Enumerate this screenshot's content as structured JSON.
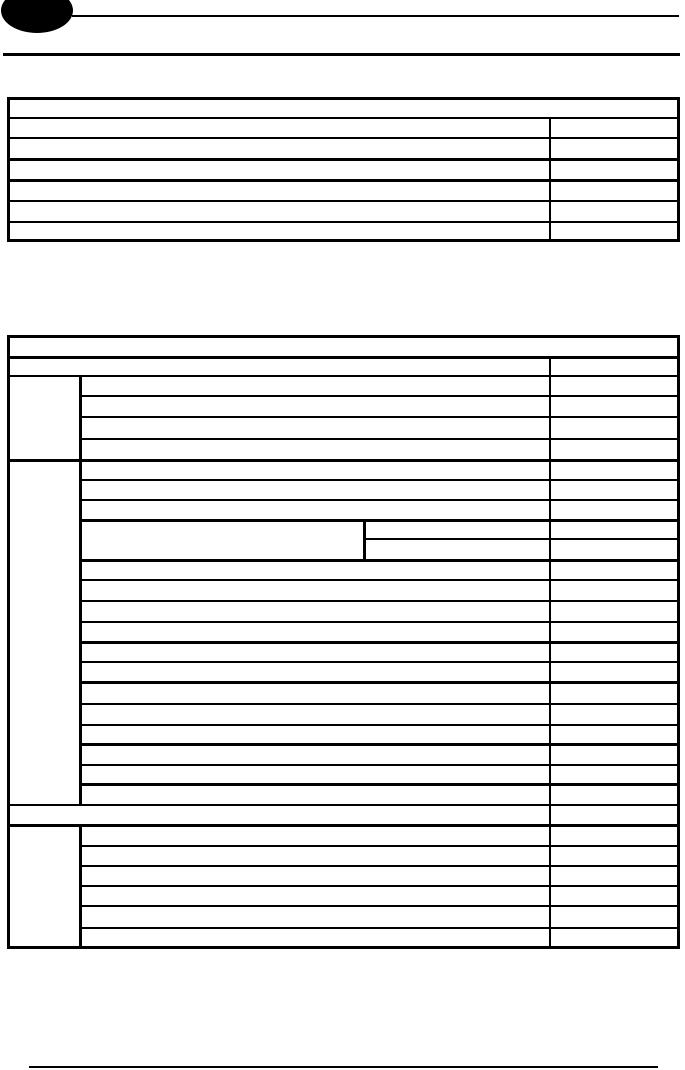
{
  "page": {
    "width": 685,
    "height": 1070,
    "background_color": "#ffffff",
    "line_color": "#000000"
  },
  "document": {
    "content_note": "blank form template page; all table cells are empty, no text is rendered",
    "tables_empty": true
  },
  "tables_meta": {
    "table1": {
      "rows": 7,
      "header_row_full_width": true,
      "value_column_divider_x": 549
    },
    "table2": {
      "header_row_full_width": true,
      "category_column_divider_x": 79,
      "value_column_divider_x": 549,
      "nested_split_divider_x": 363,
      "category_groups": 3,
      "full_width_band_y": 806
    }
  },
  "shapes": [
    {
      "name": "logo-ellipse",
      "type": "ellipse",
      "x": 1,
      "y": -12,
      "w": 72,
      "h": 45
    },
    {
      "name": "header-rule-top",
      "type": "rect",
      "x": 72,
      "y": 15,
      "w": 607,
      "h": 2
    },
    {
      "name": "header-rule-bottom",
      "type": "rect",
      "x": 3,
      "y": 53,
      "w": 677,
      "h": 3
    },
    {
      "name": "table1-border-top",
      "type": "rect",
      "x": 7,
      "y": 97,
      "w": 673,
      "h": 3
    },
    {
      "name": "table1-border-bottom",
      "type": "rect",
      "x": 7,
      "y": 239,
      "w": 673,
      "h": 3
    },
    {
      "name": "table1-border-left",
      "type": "rect",
      "x": 7,
      "y": 97,
      "w": 3,
      "h": 145
    },
    {
      "name": "table1-border-right",
      "type": "rect",
      "x": 677,
      "y": 97,
      "w": 3,
      "h": 145
    },
    {
      "name": "table1-rowline-1",
      "type": "rect",
      "x": 7,
      "y": 117,
      "w": 673,
      "h": 2
    },
    {
      "name": "table1-rowline-2",
      "type": "rect",
      "x": 7,
      "y": 137,
      "w": 673,
      "h": 2
    },
    {
      "name": "table1-rowline-3",
      "type": "rect",
      "x": 7,
      "y": 158,
      "w": 673,
      "h": 3
    },
    {
      "name": "table1-rowline-4",
      "type": "rect",
      "x": 7,
      "y": 179,
      "w": 673,
      "h": 3
    },
    {
      "name": "table1-rowline-5",
      "type": "rect",
      "x": 7,
      "y": 200,
      "w": 673,
      "h": 2
    },
    {
      "name": "table1-rowline-6",
      "type": "rect",
      "x": 7,
      "y": 221,
      "w": 673,
      "h": 2
    },
    {
      "name": "table1-value-divider",
      "type": "rect",
      "x": 549,
      "y": 117,
      "w": 2,
      "h": 125
    },
    {
      "name": "table2-border-top",
      "type": "rect",
      "x": 7,
      "y": 335,
      "w": 673,
      "h": 3
    },
    {
      "name": "table2-border-bottom",
      "type": "rect",
      "x": 7,
      "y": 946,
      "w": 673,
      "h": 3
    },
    {
      "name": "table2-border-left",
      "type": "rect",
      "x": 7,
      "y": 335,
      "w": 3,
      "h": 614
    },
    {
      "name": "table2-border-right",
      "type": "rect",
      "x": 677,
      "y": 335,
      "w": 3,
      "h": 614
    },
    {
      "name": "table2-header-bottom",
      "type": "rect",
      "x": 7,
      "y": 356,
      "w": 673,
      "h": 3
    },
    {
      "name": "table2-rowline-1",
      "type": "rect",
      "x": 7,
      "y": 375,
      "w": 673,
      "h": 2
    },
    {
      "name": "table2-rowline-2",
      "type": "rect",
      "x": 79,
      "y": 395,
      "w": 601,
      "h": 2
    },
    {
      "name": "table2-rowline-3",
      "type": "rect",
      "x": 79,
      "y": 416,
      "w": 601,
      "h": 2
    },
    {
      "name": "table2-rowline-4",
      "type": "rect",
      "x": 79,
      "y": 438,
      "w": 601,
      "h": 2
    },
    {
      "name": "table2-groupline-1",
      "type": "rect",
      "x": 7,
      "y": 459,
      "w": 673,
      "h": 3
    },
    {
      "name": "table2-rowline-5",
      "type": "rect",
      "x": 79,
      "y": 479,
      "w": 601,
      "h": 2
    },
    {
      "name": "table2-rowline-6",
      "type": "rect",
      "x": 79,
      "y": 499,
      "w": 601,
      "h": 2
    },
    {
      "name": "table2-splitblock-top",
      "type": "rect",
      "x": 79,
      "y": 519,
      "w": 601,
      "h": 3
    },
    {
      "name": "table2-splitblock-mid",
      "type": "rect",
      "x": 363,
      "y": 538,
      "w": 317,
      "h": 2
    },
    {
      "name": "table2-splitblock-bottom",
      "type": "rect",
      "x": 79,
      "y": 559,
      "w": 601,
      "h": 3
    },
    {
      "name": "table2-rowline-7",
      "type": "rect",
      "x": 79,
      "y": 579,
      "w": 601,
      "h": 2
    },
    {
      "name": "table2-rowline-8",
      "type": "rect",
      "x": 79,
      "y": 600,
      "w": 601,
      "h": 2
    },
    {
      "name": "table2-rowline-9",
      "type": "rect",
      "x": 79,
      "y": 621,
      "w": 601,
      "h": 2
    },
    {
      "name": "table2-rowline-10",
      "type": "rect",
      "x": 79,
      "y": 641,
      "w": 601,
      "h": 3
    },
    {
      "name": "table2-rowline-11",
      "type": "rect",
      "x": 79,
      "y": 661,
      "w": 601,
      "h": 2
    },
    {
      "name": "table2-rowline-12",
      "type": "rect",
      "x": 79,
      "y": 681,
      "w": 601,
      "h": 3
    },
    {
      "name": "table2-rowline-13",
      "type": "rect",
      "x": 79,
      "y": 703,
      "w": 601,
      "h": 2
    },
    {
      "name": "table2-rowline-14",
      "type": "rect",
      "x": 79,
      "y": 724,
      "w": 601,
      "h": 2
    },
    {
      "name": "table2-rowline-15",
      "type": "rect",
      "x": 79,
      "y": 743,
      "w": 601,
      "h": 3
    },
    {
      "name": "table2-rowline-16",
      "type": "rect",
      "x": 79,
      "y": 764,
      "w": 601,
      "h": 2
    },
    {
      "name": "table2-rowline-17",
      "type": "rect",
      "x": 79,
      "y": 783,
      "w": 601,
      "h": 3
    },
    {
      "name": "table2-fullband-top",
      "type": "rect",
      "x": 7,
      "y": 804,
      "w": 673,
      "h": 2
    },
    {
      "name": "table2-fullband-bottom",
      "type": "rect",
      "x": 7,
      "y": 824,
      "w": 673,
      "h": 3
    },
    {
      "name": "table2-rowline-18",
      "type": "rect",
      "x": 79,
      "y": 845,
      "w": 601,
      "h": 2
    },
    {
      "name": "table2-rowline-19",
      "type": "rect",
      "x": 79,
      "y": 865,
      "w": 601,
      "h": 2
    },
    {
      "name": "table2-rowline-20",
      "type": "rect",
      "x": 79,
      "y": 885,
      "w": 601,
      "h": 2
    },
    {
      "name": "table2-rowline-21",
      "type": "rect",
      "x": 79,
      "y": 905,
      "w": 601,
      "h": 2
    },
    {
      "name": "table2-rowline-22",
      "type": "rect",
      "x": 79,
      "y": 927,
      "w": 601,
      "h": 2
    },
    {
      "name": "table2-category-divider-upper",
      "type": "rect",
      "x": 79,
      "y": 375,
      "w": 3,
      "h": 431
    },
    {
      "name": "table2-category-divider-lower",
      "type": "rect",
      "x": 79,
      "y": 824,
      "w": 3,
      "h": 125
    },
    {
      "name": "table2-value-divider",
      "type": "rect",
      "x": 549,
      "y": 356,
      "w": 2,
      "h": 593
    },
    {
      "name": "table2-split-divider",
      "type": "rect",
      "x": 363,
      "y": 519,
      "w": 3,
      "h": 42
    },
    {
      "name": "footer-rule",
      "type": "rect",
      "x": 29,
      "y": 1066,
      "w": 629,
      "h": 2
    }
  ]
}
